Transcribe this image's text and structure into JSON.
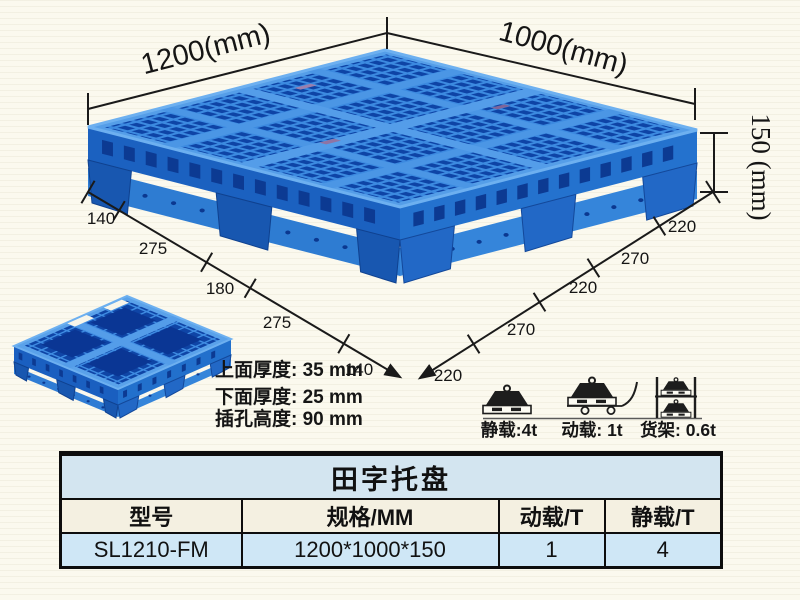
{
  "dimensions": {
    "length_label": "1200(mm)",
    "width_label": "1000(mm)",
    "height_label": "150 (mm)",
    "bottom_left_segments": [
      "140",
      "275",
      "180",
      "275",
      "140"
    ],
    "bottom_right_segments": [
      "220",
      "270",
      "220",
      "270",
      "220"
    ]
  },
  "notes": [
    "上面厚度: 35 mm",
    "下面厚度: 25 mm",
    "插孔高度: 90 mm"
  ],
  "load_ratings": [
    {
      "icon": "static-load-icon",
      "label": "静载:4t"
    },
    {
      "icon": "dynamic-load-icon",
      "label": "动载: 1t"
    },
    {
      "icon": "rack-load-icon",
      "label": "货架: 0.6t"
    }
  ],
  "spec_table": {
    "title": "田字托盘",
    "headers": [
      "型号",
      "规格/MM",
      "动载/T",
      "静载/T"
    ],
    "rows": [
      [
        "SL1210-FM",
        "1200*1000*150",
        "1",
        "4"
      ]
    ]
  },
  "palette": {
    "pallet_blue": "#2b7cd8",
    "pallet_dark_hole": "#0e44a6",
    "pallet_light_rib": "#58a0e8",
    "table_title_bg": "#d3e5f0",
    "table_header_bg": "#f4f0e1",
    "table_data_bg": "#cfe7f6",
    "line_color": "#1a1a1a"
  }
}
